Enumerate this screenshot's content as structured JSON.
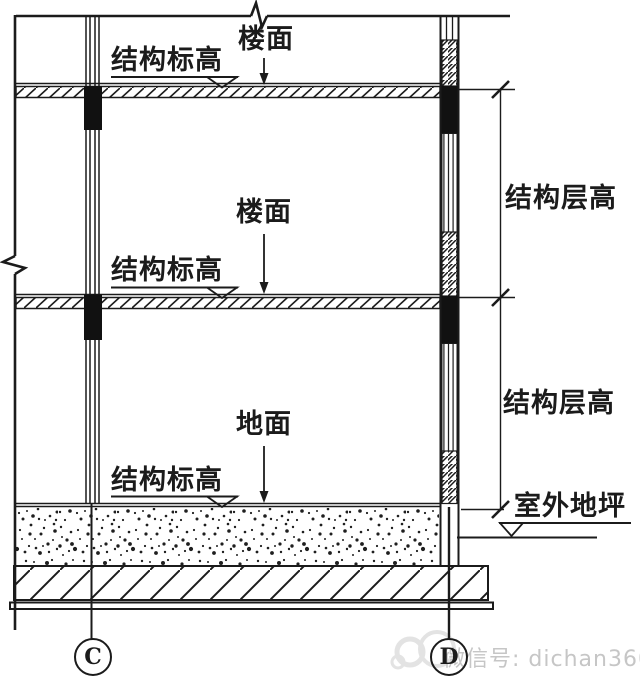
{
  "diagram": {
    "type": "building-section-structural-detail",
    "annotations": {
      "floor_upper": "楼面",
      "struct_elev_upper": "结构标高",
      "floor_mid": "楼面",
      "struct_elev_mid": "结构标高",
      "ground": "地面",
      "struct_elev_ground": "结构标高",
      "story_height_upper": "结构层高",
      "story_height_lower": "结构层高",
      "outdoor_ground": "室外地坪"
    },
    "grid_bubbles": {
      "left": "C",
      "right": "D"
    }
  },
  "watermark": {
    "text": "微信号: dichan360",
    "color": "#c6c6c6"
  },
  "colors": {
    "ink": "#1b1b1b",
    "background": "#ffffff"
  }
}
